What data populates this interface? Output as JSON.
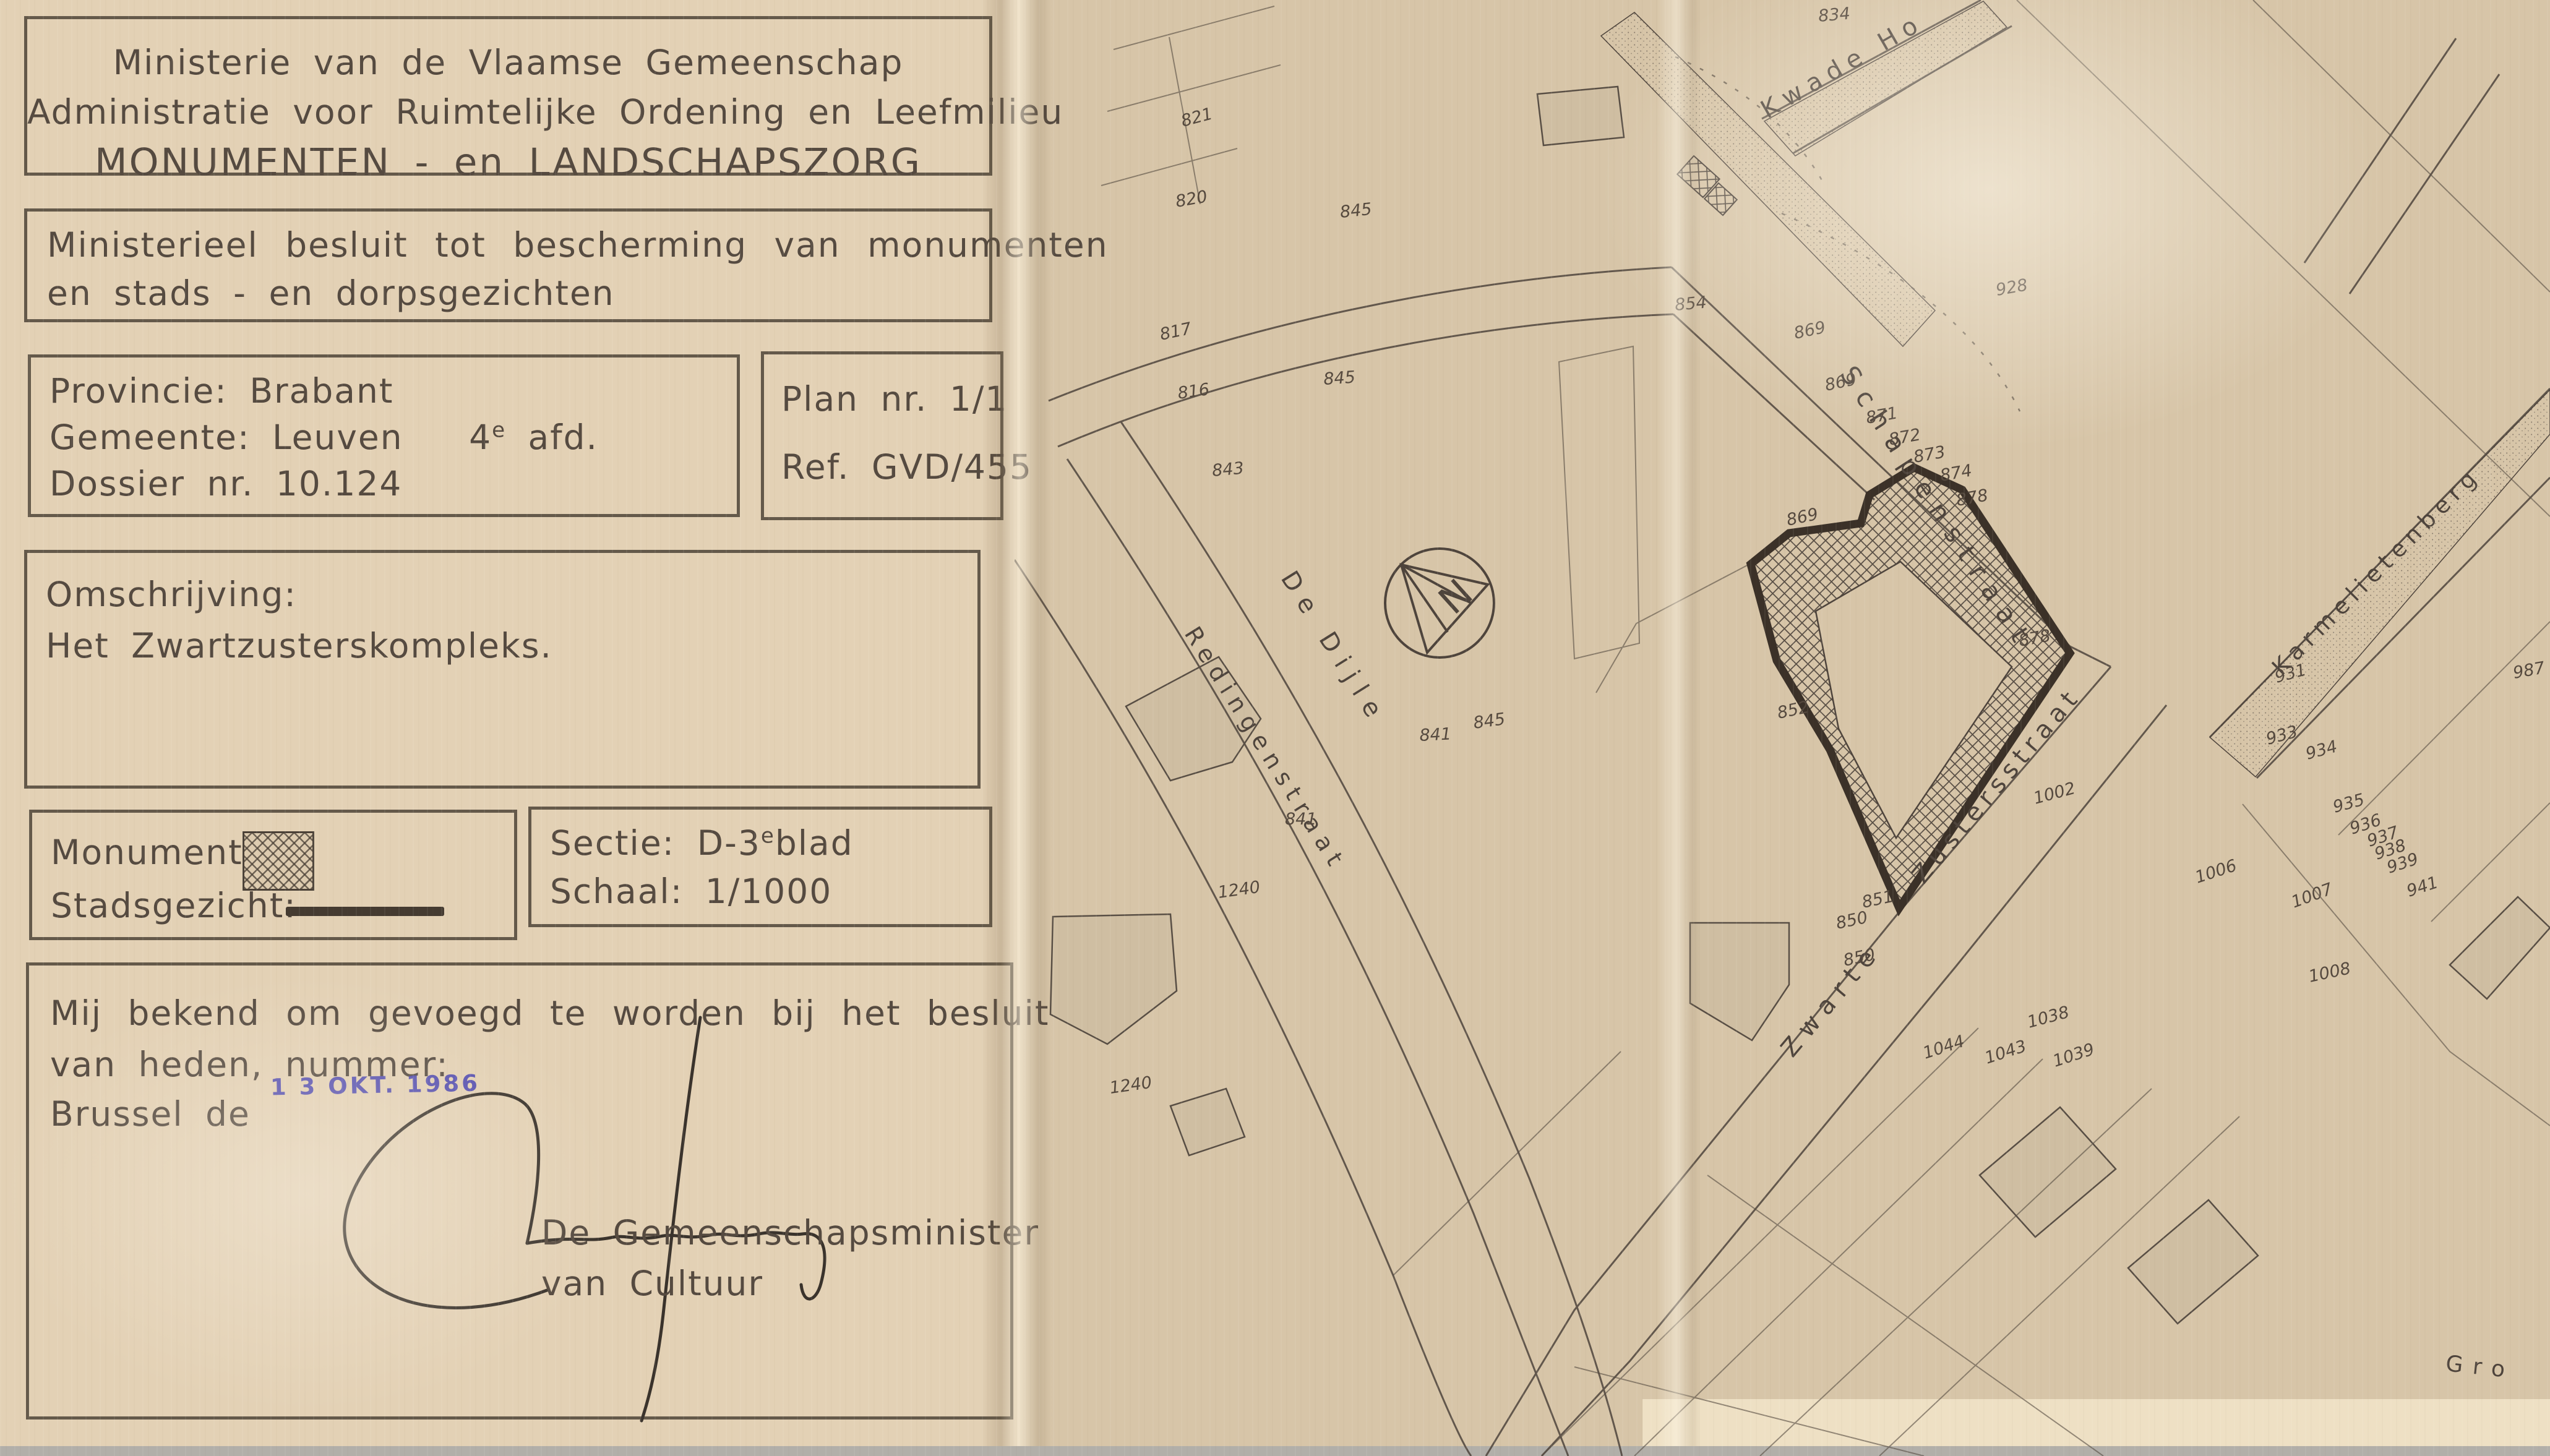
{
  "panel": {
    "header": {
      "line1": "Ministerie van de Vlaamse Gemeenschap",
      "line2": "Administratie voor Ruimtelijke Ordening en Leefmilieu",
      "line3": "MONUMENTEN - en LANDSCHAPSZORG"
    },
    "decree": {
      "line1": "Ministerieel besluit tot bescherming van monumenten",
      "line2": "en stads - en dorpsgezichten"
    },
    "dossier": {
      "province_label": "Provincie:",
      "province_value": "Brabant",
      "gemeente_label": "Gemeente:",
      "gemeente_value": "Leuven",
      "afd_num": "4",
      "afd_sup": "e",
      "afd_rest": "afd.",
      "dossier_label": "Dossier nr.",
      "dossier_value": "10.124"
    },
    "plan": {
      "plan_label": "Plan nr.",
      "plan_value": "1/1",
      "ref_label": "Ref.",
      "ref_value": "GVD/455"
    },
    "description": {
      "label": "Omschrijving:",
      "value": "Het Zwartzusterskompleks."
    },
    "legend": {
      "monument_label": "Monument:",
      "stadsgezicht_label": "Stadsgezicht:"
    },
    "section": {
      "sectie_label": "Sectie:",
      "sectie_value": "D-3",
      "sectie_sup": "e",
      "sectie_rest": "blad",
      "schaal_label": "Schaal:",
      "schaal_value": "1/1000"
    },
    "attestation": {
      "line1": "Mij bekend om gevoegd te worden bij het besluit",
      "line2": "van heden, nummer:",
      "line3": "Brussel de",
      "date_stamp": "1 3 OKT. 1986",
      "signatory_line1": "De Gemeenschapsminister",
      "signatory_line2": "van Cultuur"
    }
  },
  "map": {
    "north": "N",
    "streets": [
      {
        "name": "Kwade Ho"
      },
      {
        "name": "Schapenstraat"
      },
      {
        "name": "Zwarte"
      },
      {
        "name": "Zustersstraat"
      },
      {
        "name": "Karmelietenberg"
      },
      {
        "name": "Redingenstraat"
      },
      {
        "name": "De Dijle"
      },
      {
        "name": "Gro"
      }
    ],
    "parcels": [
      "821",
      "820",
      "817",
      "816",
      "843",
      "841",
      "841",
      "845",
      "845",
      "845",
      "854",
      "834",
      "928",
      "869",
      "869",
      "869",
      "871",
      "872",
      "873",
      "874",
      "878",
      "878",
      "852",
      "851",
      "850",
      "850",
      "1044",
      "1043",
      "1039",
      "1038",
      "1002",
      "1006",
      "1007",
      "1008",
      "931",
      "933",
      "934",
      "935",
      "936",
      "937",
      "938",
      "939",
      "941",
      "987",
      "1240",
      "1240"
    ]
  },
  "colors": {
    "paper_doc": "#e3d1b5",
    "paper_map": "#d7c5a8",
    "ink": "#554a40",
    "map_line": "#4e443c",
    "boundary": "#3b3128",
    "stamp_blue": "#4b46b0"
  }
}
